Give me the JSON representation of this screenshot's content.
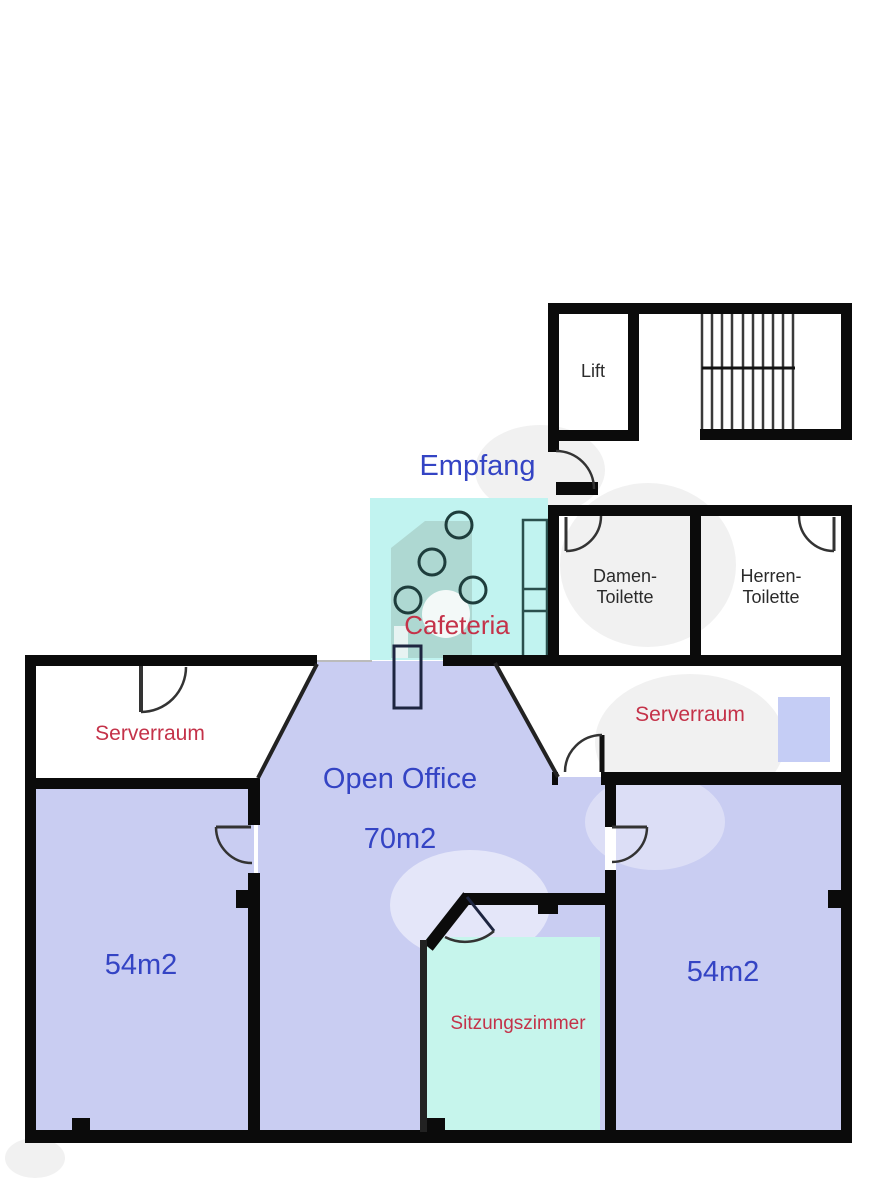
{
  "floorplan": {
    "rooms": {
      "empfang": {
        "label": "Empfang"
      },
      "lift": {
        "label": "Lift"
      },
      "cafeteria": {
        "label": "Cafeteria"
      },
      "damen_toilette": {
        "label": "Damen-\nToilette"
      },
      "herren_toilette": {
        "label": "Herren-\nToilette"
      },
      "serverraum_left": {
        "label": "Serverraum"
      },
      "serverraum_right": {
        "label": "Serverraum"
      },
      "open_office": {
        "label": "Open Office",
        "area": "70m2"
      },
      "room_left": {
        "area": "54m2"
      },
      "room_right": {
        "area": "54m2"
      },
      "sitzungszimmer": {
        "label": "Sitzungszimmer"
      }
    },
    "colors": {
      "wall": "#0b0b0b",
      "open_office_fill": "#c9cdf2",
      "cafeteria_fill": "#c1f3f0",
      "sitzungszimmer_fill": "#c6f5ec",
      "server_rack_fill": "#c5cdf5",
      "label_blue": "#3444c4",
      "label_red": "#c43249",
      "label_dark": "#2b2b2b",
      "watermark_gray": "#f1f1f1",
      "watermark_logo": "#aed8d2"
    }
  }
}
